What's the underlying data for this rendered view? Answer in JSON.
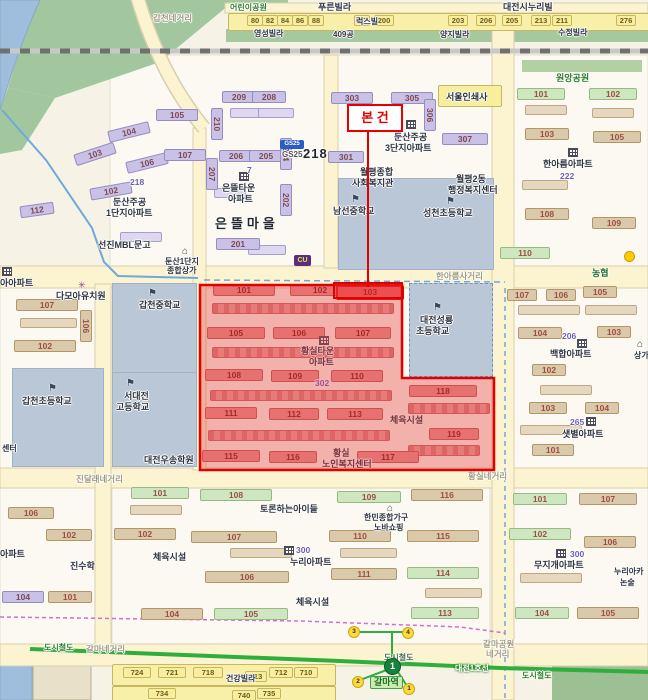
{
  "subject": {
    "label": "본 건"
  },
  "colors": {
    "highlight_border": "#e60000",
    "highlight_fill": "rgba(232,60,60,0.38)",
    "subway_green": "#2fae3e"
  },
  "roads": {
    "gapcheon": "갑천네거리",
    "hanareum": "한아름사거리",
    "jindallae": "진달래네거리",
    "hwangsil": "황실네거리",
    "galma_park_1": "갈마공원",
    "galma_park_2": "네거리",
    "galma": "갈마네거리"
  },
  "transit": {
    "rail1": "도시철도",
    "rail2": "도시철도",
    "rail3": "도시철도",
    "line_name": "대전1호선",
    "station": "갈마역",
    "line_badge": "1",
    "exit3": "3",
    "exit4": "4",
    "exit2": "2",
    "exit1": "1"
  },
  "top_strip": {
    "park": "어린이공원",
    "pureun": "푸른빌라",
    "nuribil": "대전시누리빌",
    "yeongseong": "영성빌라",
    "lot409": "409공",
    "luxvill": "럭스빌",
    "yangji": "양지빌라",
    "sujeong": "수정빌라",
    "n": [
      "80",
      "82",
      "84",
      "86",
      "88",
      "92",
      "200",
      "203",
      "206",
      "205",
      "213",
      "211",
      "276"
    ]
  },
  "pois": {
    "gs25_logo": "GS25",
    "gs25": "GS25",
    "cu": "CU",
    "nh": "농협",
    "print_shop": "서울인쇄사",
    "sangga1": "둔산1단지",
    "sangga2": "종합상가",
    "kindergarten": "다모아유치원",
    "bookstore": "선진MBL문고",
    "welfare1": "월평종합",
    "welfare2": "사회복지관",
    "admin1": "월평2동",
    "admin2": "행정복지센터",
    "woosong": "대전우송학원",
    "debate": "토론하는아이들",
    "hanmin1": "한민종합가구",
    "hanmin2": "노바쇼핑",
    "jinsu": "진수학",
    "geonkang": "건강빌라",
    "nuriaca1": "누리아카",
    "nuriaca2": "논술",
    "sangga_r": "상가",
    "center_partial": "센터",
    "sports1": "체육시설",
    "sports2": "체육시설",
    "sports3": "체육시설",
    "wonang_park": "원앙공원"
  },
  "schools": {
    "namseon": "남선중학교",
    "seongcheon": "성천초등학교",
    "gapcheon_mid": "갑천중학교",
    "seodaejeon1": "서대전",
    "seodaejeon2": "고등학교",
    "gapcheon_ele": "갑천초등학교",
    "seongryong1": "대전성룡",
    "seongryong2": "초등학교"
  },
  "complexes": {
    "dunsan1": {
      "l1": "둔산주공",
      "l2": "1단지아파트",
      "tag": "218",
      "b": [
        "105",
        "104",
        "103",
        "102",
        "106",
        "107",
        "112",
        "210",
        "209",
        "208",
        "206",
        "205",
        "207",
        "204",
        "202"
      ]
    },
    "eundeul": {
      "s1": "은뜰타운",
      "s2": "아파트",
      "big": "은뜰마을",
      "n7": "7",
      "b201": "201",
      "big218": "218"
    },
    "dunsan3": {
      "l1": "둔산주공",
      "l2": "3단지아파트",
      "b": [
        "303",
        "305",
        "306",
        "301",
        "307"
      ]
    },
    "hanareum": {
      "name": "한아름아파트",
      "num": "222",
      "b": [
        "101",
        "102",
        "103",
        "105",
        "108",
        "109",
        "110"
      ]
    },
    "hwangsil": {
      "l1": "황실타운",
      "l2": "아파트",
      "num": "302",
      "w1": "황실",
      "w2": "노인복지센터",
      "b": [
        "101",
        "102",
        "103",
        "105",
        "106",
        "107",
        "108",
        "109",
        "110",
        "111",
        "112",
        "113",
        "115",
        "116",
        "117",
        "118",
        "119"
      ]
    },
    "baekhap": {
      "name": "백합아파트",
      "num": "206",
      "b": [
        "107",
        "106",
        "105",
        "104",
        "103",
        "102"
      ]
    },
    "saetbyeol": {
      "name": "샛별아파트",
      "num": "265",
      "b": [
        "103",
        "104",
        "101"
      ]
    },
    "mujigae": {
      "name": "무지개아파트",
      "num": "300",
      "b": [
        "101",
        "107",
        "102",
        "106",
        "104",
        "105"
      ]
    },
    "nuri": {
      "name": "누리아파트",
      "num": "300"
    },
    "center_south": {
      "b": [
        "101",
        "108",
        "102",
        "107",
        "106",
        "104",
        "105",
        "109",
        "116",
        "110",
        "115",
        "111",
        "114",
        "113"
      ]
    },
    "west_mid": {
      "partial": "아아파트",
      "b": [
        "107",
        "106",
        "102"
      ]
    },
    "west_south": {
      "partial": "아파트",
      "b": [
        "106",
        "102",
        "104",
        "101"
      ]
    },
    "bottom_strip": {
      "r1": [
        "724",
        "721",
        "718",
        "713",
        "712",
        "710"
      ],
      "r2": [
        "734",
        "740",
        "735"
      ]
    }
  }
}
